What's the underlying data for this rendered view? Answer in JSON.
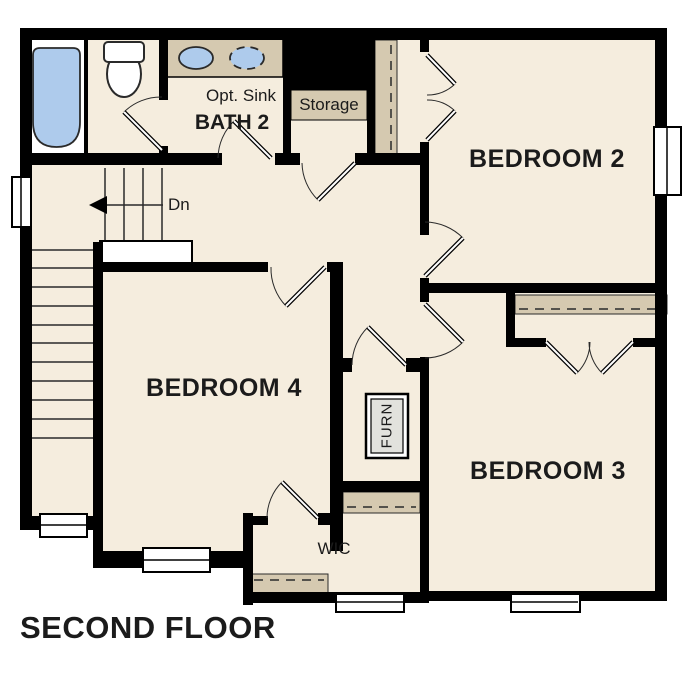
{
  "floor_plan": {
    "title": "SECOND FLOOR",
    "rooms": {
      "bedroom2": "BEDROOM 2",
      "bedroom3": "BEDROOM 3",
      "bedroom4": "BEDROOM 4",
      "bath2": "BATH 2",
      "storage": "Storage",
      "wic": "WIC",
      "furnace": "FURN"
    },
    "annotations": {
      "optional_sink": "Opt. Sink",
      "stairs_down": "Dn"
    },
    "colors": {
      "floor": "#f5edde",
      "wall": "#000000",
      "casework": "#d5c9b0",
      "fixture_blue": "#aecbec",
      "furnace_gray": "#e2e2dd",
      "white": "#ffffff",
      "line": "#2a2a2a"
    }
  }
}
